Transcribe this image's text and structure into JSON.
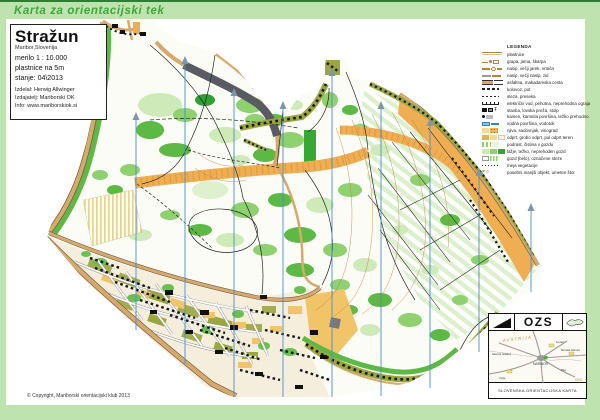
{
  "banner": {
    "title": "Karta za orientacijski tek"
  },
  "title_block": {
    "name": "Stražun",
    "location": "Maribor,Slovenija",
    "scale": "merilo 1 : 10.000",
    "contour_interval": "plastnice na 5m",
    "state": "stanje: 04\\2013",
    "made_by": "Izdelal: Herwig Allwinger",
    "publisher": "Izdajatelj: Mariborski OK",
    "info": "Info: www.mariborskiok.si"
  },
  "legend": {
    "title": "LEGENDA",
    "items": [
      {
        "label": "plastnice",
        "sym": "contour"
      },
      {
        "label": "grapa, jama, škarpa",
        "sym": "earth"
      },
      {
        "label": "nasip, večji jarek, vrtača",
        "sym": "earth2"
      },
      {
        "label": "nasip, večji nasip, zid",
        "sym": "wall"
      },
      {
        "label": "asfaltna, makadamska cesta",
        "sym": "roads"
      },
      {
        "label": "kolovoz, pot",
        "sym": "track"
      },
      {
        "label": "steza, preseka",
        "sym": "path"
      },
      {
        "label": "električni vod, pehotna, neprehodna ograja",
        "sym": "fence"
      },
      {
        "label": "stavba, lovska preža, stolp",
        "sym": "building"
      },
      {
        "label": "kamen, kamnita površina, težko prehodno",
        "sym": "rock"
      },
      {
        "label": "vodna površina, vodotok",
        "sym": "water"
      },
      {
        "label": "njiva, sadovnjak, vinograd",
        "sym": "farm"
      },
      {
        "label": "odprt, grobo odprt, pol odprt teren",
        "sym": "open"
      },
      {
        "label": "podrast, čistina v gozdu",
        "sym": "undergrowth"
      },
      {
        "label": "lažje, težko, neprehoden gozd",
        "sym": "forest"
      },
      {
        "label": "gozd (belo), označene steze",
        "sym": "whiteforest"
      },
      {
        "label": "meja vegetacije",
        "sym": "vegboundary"
      },
      {
        "label": "posebni manjši objekt, umeten štor",
        "sym": "objects"
      }
    ]
  },
  "ozs": {
    "logo": "OZS",
    "subtitle": "SLOVENSKA ORIENTACIJSKA KARTA",
    "map_labels": {
      "country_top": "AVSTRIJA",
      "city": "MARIBOR",
      "nw": "Slovenj Gradec",
      "ne": "Lenart",
      "e": "Murska Sobota",
      "se": "Ptuj",
      "sw": "Celje",
      "country_bottom": "CRO"
    }
  },
  "footer": {
    "copyright": "© Copyright, Mariborski orientacijski klub 2013"
  },
  "colors": {
    "frame_green": "#bfe3ae",
    "top_line_green": "#2e7d32",
    "banner_text_green": "#3fa63c",
    "north_blue": "#4a90c8",
    "arrow_gray": "#7d97aa",
    "map_orange": "#f0ae52",
    "map_olive": "#9aa73f",
    "map_bright_green": "#5cb944",
    "map_pale_green": "#cdeab8",
    "water_blue": "#7ec8e8",
    "contour_brown": "#b9813f"
  }
}
